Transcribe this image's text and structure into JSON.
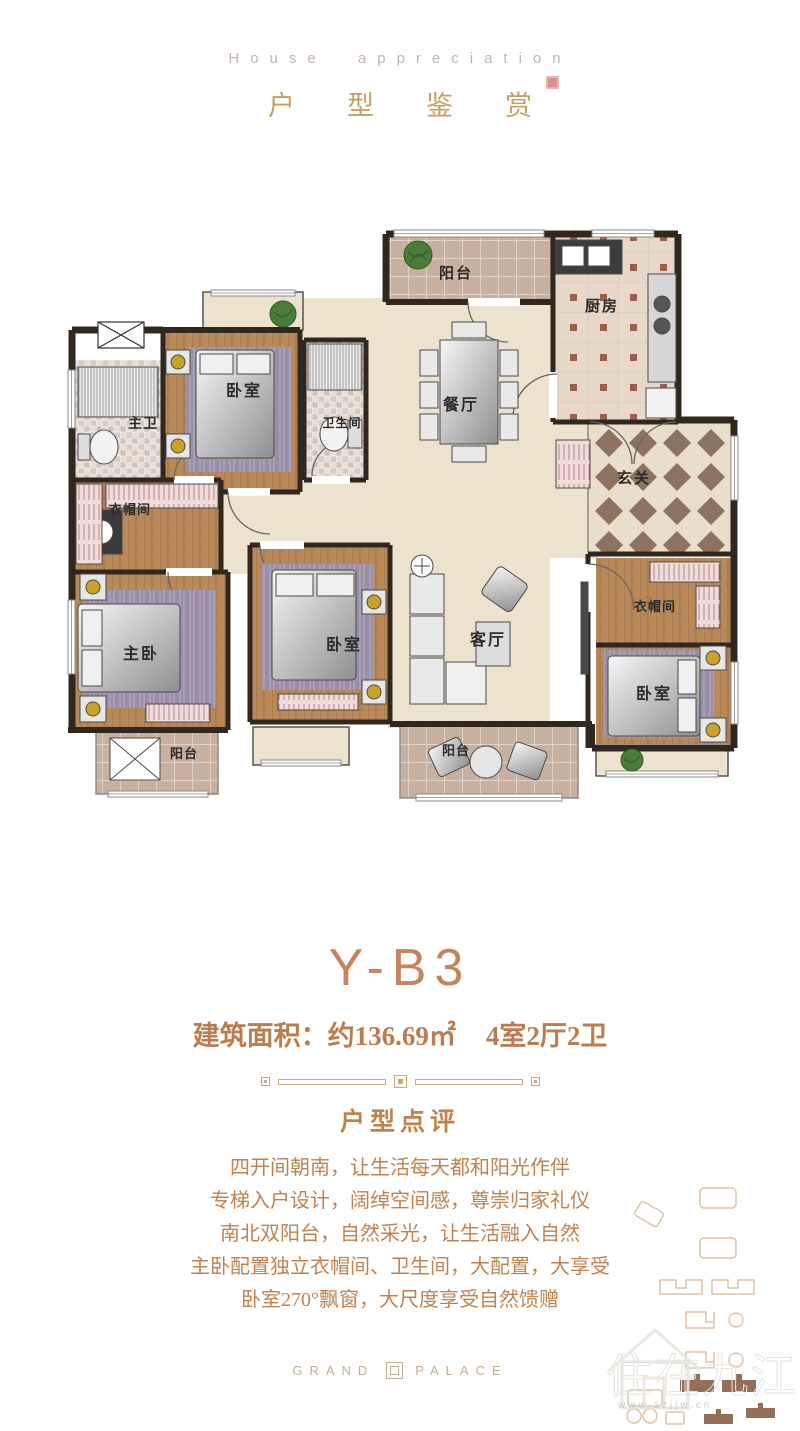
{
  "header": {
    "subtitle_en": "House appreciation",
    "title": "户型鉴赏"
  },
  "floorplan": {
    "rooms": [
      {
        "id": "balcony-north",
        "label": "阳台"
      },
      {
        "id": "kitchen",
        "label": "厨房"
      },
      {
        "id": "dining",
        "label": "餐厅"
      },
      {
        "id": "entry",
        "label": "玄关"
      },
      {
        "id": "bedroom-nw",
        "label": "卧室"
      },
      {
        "id": "master-bath",
        "label": "主卫"
      },
      {
        "id": "bathroom",
        "label": "卫生间"
      },
      {
        "id": "cloakroom-west",
        "label": "衣帽间"
      },
      {
        "id": "master-bedroom",
        "label": "主卧"
      },
      {
        "id": "balcony-sw",
        "label": "阳台"
      },
      {
        "id": "bedroom-south",
        "label": "卧室"
      },
      {
        "id": "living",
        "label": "客厅"
      },
      {
        "id": "balcony-south",
        "label": "阳台"
      },
      {
        "id": "cloakroom-east",
        "label": "衣帽间"
      },
      {
        "id": "bedroom-se",
        "label": "卧室"
      }
    ]
  },
  "unit": {
    "name": "Y-B3",
    "area_label": "建筑面积：",
    "area_value": "约136.69㎡",
    "layout": "4室2厅2卫"
  },
  "review": {
    "heading": "户型点评",
    "lines": [
      "四开间朝南，让生活每天都和阳光作伴",
      "专梯入户设计，阔绰空间感，尊崇归家礼仪",
      "南北双阳台，自然采光，让生活融入自然",
      "主卧配置独立衣帽间、卫生间，大配置，大享受",
      "卧室270°飘窗，大尺度享受自然馈赠"
    ]
  },
  "footer": {
    "brand_left": "GRAND",
    "brand_right": "PALACE"
  },
  "watermark": {
    "logo_text": "住在九江",
    "url": "www.zzjjw.cn"
  },
  "colors": {
    "accent_gold": "#c69f63",
    "copper": "#c5845c",
    "seal_red": "#d88f8f",
    "wall": "#30281f"
  }
}
